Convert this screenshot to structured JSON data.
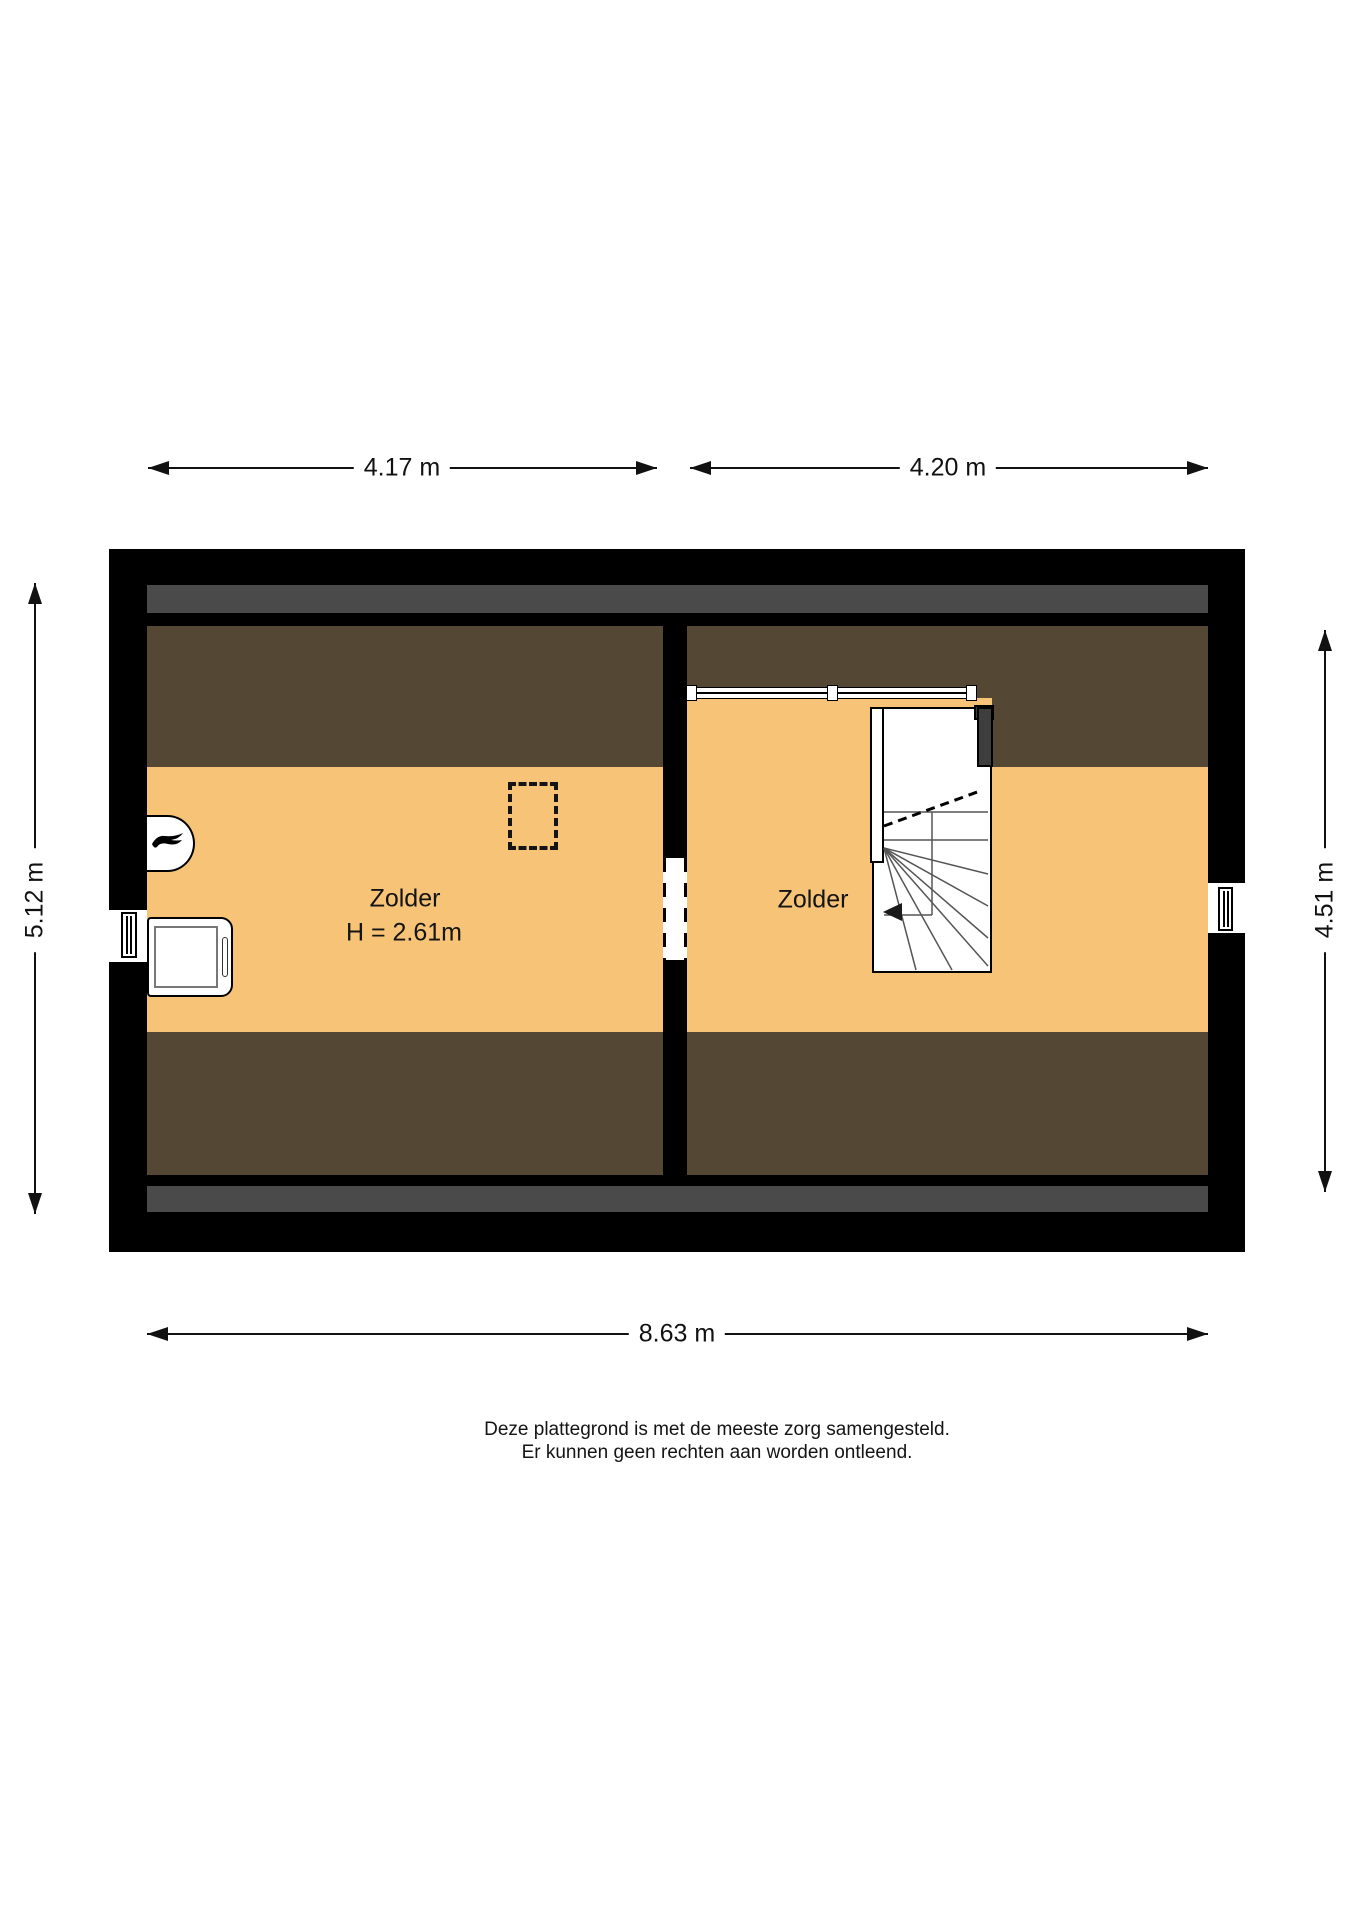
{
  "floorplan": {
    "floor_name": "Zolder (attic) floor plan",
    "rooms": {
      "left": {
        "name": "Zolder",
        "ceiling_height": "H = 2.61m"
      },
      "right": {
        "name": "Zolder"
      }
    },
    "dimensions": {
      "room_left_width": "4.17 m",
      "room_right_width": "4.20 m",
      "left_side_depth": "5.12 m",
      "right_side_depth": "4.51 m",
      "total_width": "8.63 m"
    },
    "fixtures": [
      "boiler-with-flame-icon",
      "washing-machine",
      "roof-window-dashed",
      "winder-staircase",
      "stair-direction-arrow",
      "railing",
      "left-wall-window",
      "right-wall-window",
      "duct"
    ],
    "colors": {
      "floor": "#F6C377",
      "sloped_ceiling": "#544834",
      "wall": "#000000",
      "ridge_strip": "#4A4A4A",
      "duct": "#3E3E3E",
      "dimension_line": "#111111"
    }
  },
  "disclaimer": {
    "line1": "Deze plattegrond is met de meeste zorg samengesteld.",
    "line2": "Er kunnen geen rechten aan worden ontleend."
  }
}
